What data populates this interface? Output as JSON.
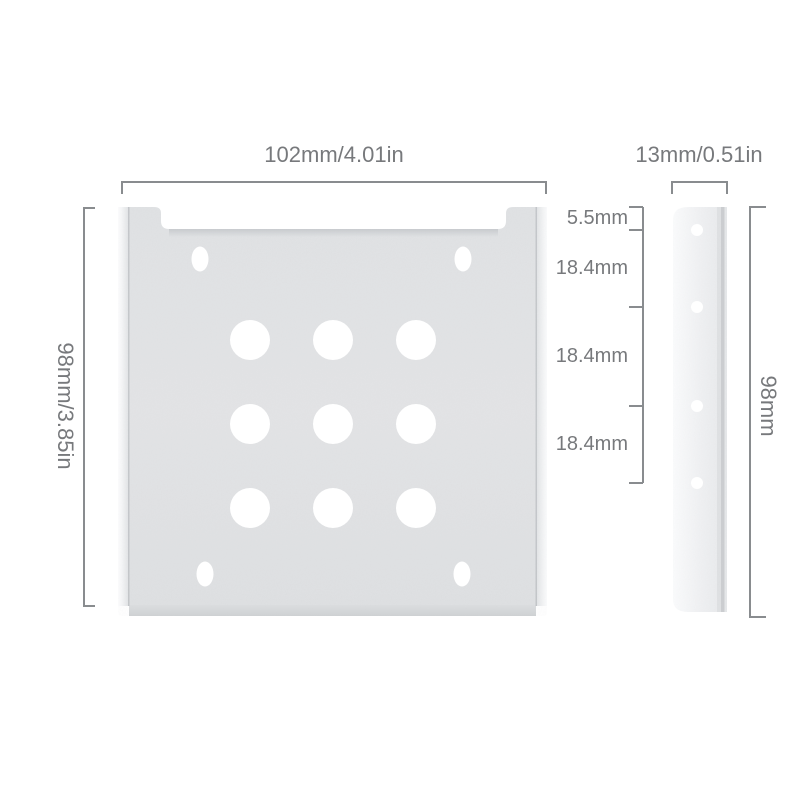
{
  "dimensions": {
    "front_width": "102mm/4.01in",
    "front_height": "98mm/3.85in",
    "side_width": "13mm/0.51in",
    "side_height": "98mm",
    "hole_spacing_segments": [
      {
        "label": "5.5mm"
      },
      {
        "label": "18.4mm"
      },
      {
        "label": "18.4mm"
      },
      {
        "label": "18.4mm"
      }
    ]
  },
  "features": {
    "front_view": {
      "large_holes": 9,
      "corner_slots": 4
    },
    "side_view": {
      "screw_holes": 4
    }
  },
  "colors": {
    "background": "#ffffff",
    "metal_face": "#e2e3e5",
    "dimension_line": "#898c8f",
    "label_text": "#77797c"
  }
}
